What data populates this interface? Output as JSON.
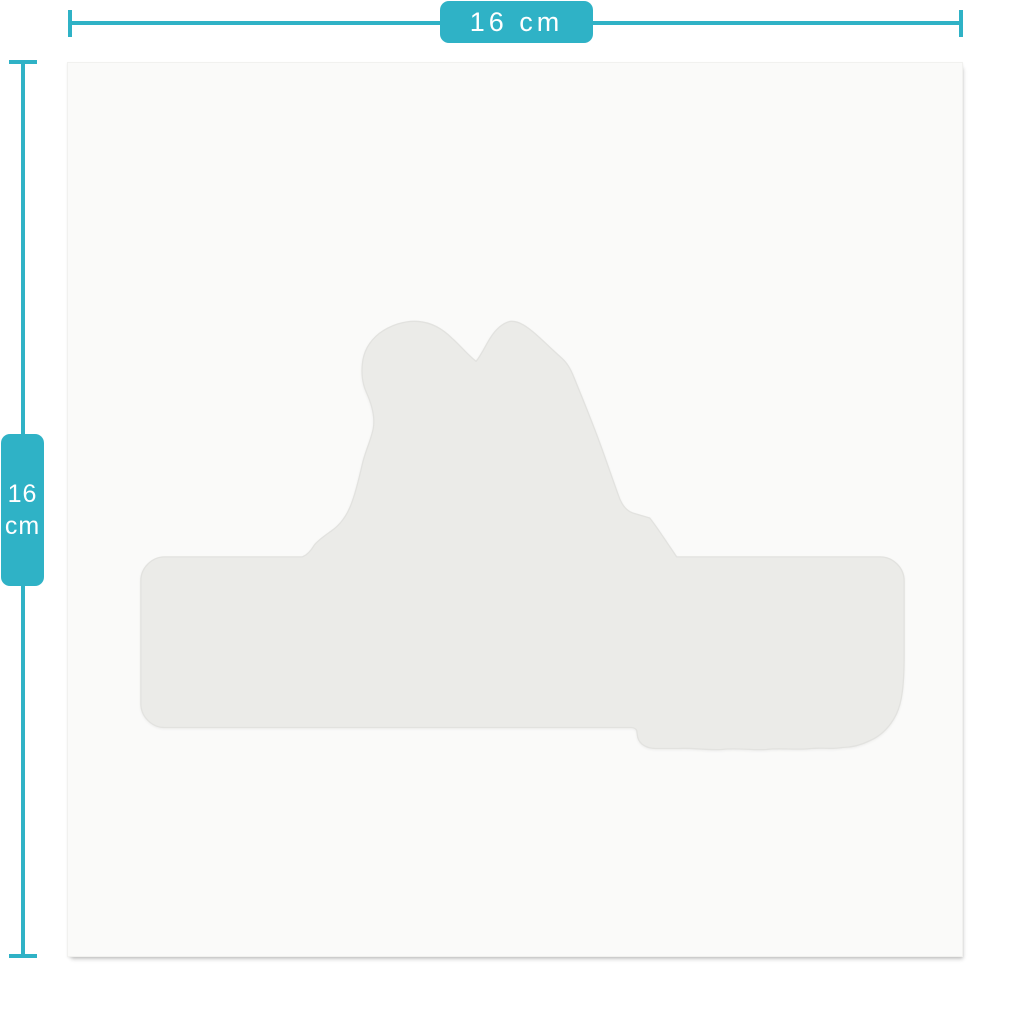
{
  "colors": {
    "accent": "#2fb2c6",
    "page_background": "#ffffff",
    "sheet_background": "#fafaf9",
    "silhouette_fill": "#ebebe8",
    "silhouette_edge": "#e2e2df"
  },
  "dimensions": {
    "width": {
      "label": "16 cm"
    },
    "height": {
      "value": "16",
      "unit": "cm"
    }
  },
  "sticker": {
    "silhouette_icon": "dog-head-on-name-plate-die-cut"
  }
}
